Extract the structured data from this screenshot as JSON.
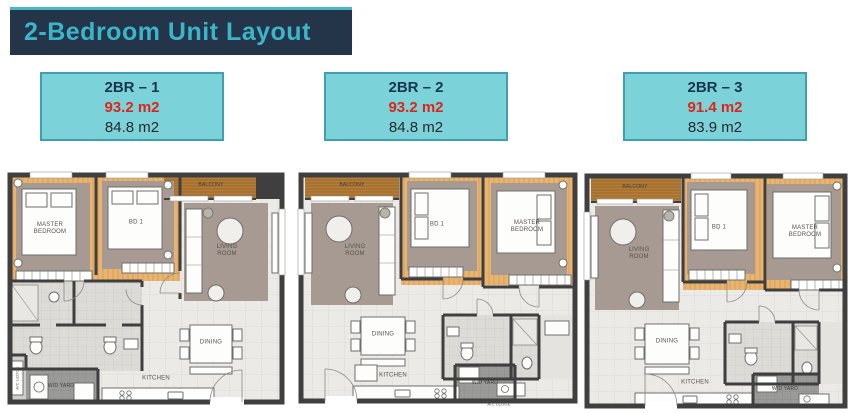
{
  "page": {
    "title": "2-Bedroom Unit Layout"
  },
  "theme": {
    "header_bg": "#24354a",
    "header_text": "#3cb5c9",
    "top_line": "#49b7c8",
    "card_bg": "#7cd2d9",
    "card_border": "#3f9fae",
    "unit_name_color": "#16364e",
    "gross_area_color": "#df2519",
    "wood_floor": "#e9b46f",
    "balcony_deck": "#b27c3b",
    "wall": "#3f3f3f"
  },
  "units": [
    {
      "name": "2BR – 1",
      "gross_area": "93.2 m2",
      "net_area": "84.8 m2"
    },
    {
      "name": "2BR – 2",
      "gross_area": "93.2 m2",
      "net_area": "84.8 m2"
    },
    {
      "name": "2BR – 3",
      "gross_area": "91.4 m2",
      "net_area": "83.9 m2"
    }
  ],
  "floorplan_labels": {
    "master_bedroom": "MASTER BEDROOM",
    "bedroom1": "BD 1",
    "balcony": "BALCONY",
    "living_room": "LIVING ROOM",
    "dining": "DINING",
    "kitchen": "KITCHEN",
    "wd_yard": "W/D YARD",
    "ac_ledge": "A/C LEDGE"
  }
}
